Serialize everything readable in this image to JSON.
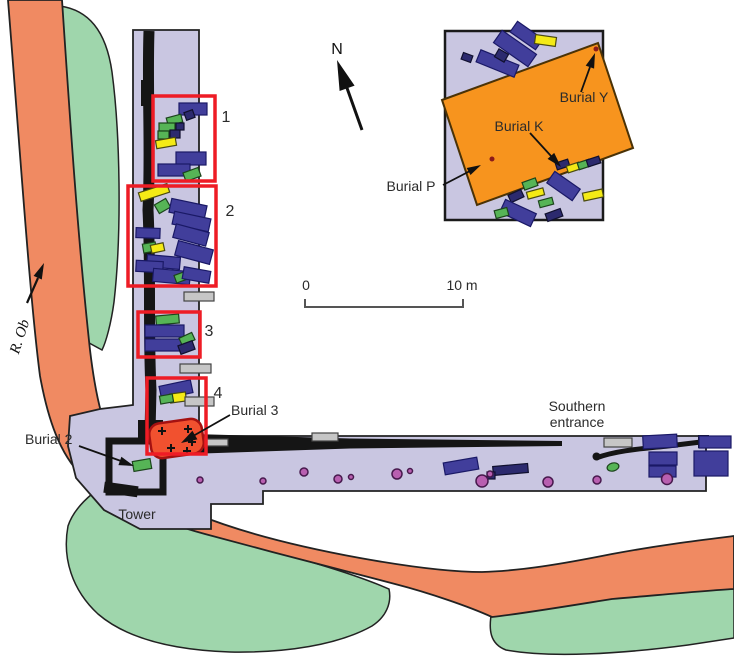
{
  "palette": {
    "background": "#ffffff",
    "site_fill": "#c9c6e1",
    "river_fill": "#f08a62",
    "vegetation_fill": "#9fd6ac",
    "outline": "#222222",
    "wall": "#151515",
    "excavation_red": "#ee1c25",
    "inset_structure_fill": "#f7941e",
    "inset_structure_stroke": "#4a3206",
    "burial3_fill": "#f1512f",
    "burial3_stroke": "#a51111",
    "pit_fill": "#b85fb0",
    "pit_stroke": "#47194d",
    "burial_dot": "#8b1a1a",
    "text": "#2b2b2b",
    "grave_colors": {
      "blue": {
        "fill": "#413e9b",
        "stroke": "#1a1966"
      },
      "navy": {
        "fill": "#2c2a6e",
        "stroke": "#10102e"
      },
      "green": {
        "fill": "#56b456",
        "stroke": "#1c441c"
      },
      "yellow": {
        "fill": "#f4ea16",
        "stroke": "#4a4a10"
      },
      "gray": {
        "fill": "#c6c6c6",
        "stroke": "#444444"
      }
    }
  },
  "map": {
    "north": "N",
    "river": "R. Ob",
    "tower": "Tower",
    "burial2": "Burial 2",
    "burial3": "Burial 3",
    "southern": [
      "Southern",
      "entrance"
    ],
    "scale_zero": "0",
    "scale_ten": "10 m"
  },
  "inset": {
    "burial_y": "Burial Y",
    "burial_k": "Burial K",
    "burial_p": "Burial P"
  },
  "excavation_areas": [
    {
      "x": 153,
      "y": 96,
      "w": 62,
      "h": 85,
      "label": "1",
      "lx": 226,
      "ly": 122
    },
    {
      "x": 128,
      "y": 186,
      "w": 88,
      "h": 100,
      "label": "2",
      "lx": 230,
      "ly": 216
    },
    {
      "x": 138,
      "y": 312,
      "w": 62,
      "h": 45,
      "label": "3",
      "lx": 209,
      "ly": 336
    },
    {
      "x": 147,
      "y": 378,
      "w": 59,
      "h": 76,
      "label": "4",
      "lx": 218,
      "ly": 398
    }
  ],
  "features": {
    "graves": [
      [
        179,
        103,
        28,
        12,
        0,
        "blue"
      ],
      [
        167,
        116,
        15,
        8,
        -15,
        "green"
      ],
      [
        185,
        111,
        9,
        8,
        -20,
        "navy"
      ],
      [
        159,
        123,
        16,
        8,
        0,
        "green"
      ],
      [
        176,
        123,
        8,
        7,
        0,
        "navy"
      ],
      [
        158,
        131,
        11,
        8,
        0,
        "green"
      ],
      [
        170,
        130,
        10,
        8,
        0,
        "navy"
      ],
      [
        156,
        139,
        20,
        8,
        -10,
        "yellow"
      ],
      [
        176,
        152,
        30,
        13,
        0,
        "blue"
      ],
      [
        158,
        164,
        32,
        12,
        0,
        "blue"
      ],
      [
        184,
        170,
        16,
        9,
        -20,
        "green"
      ],
      [
        139,
        188,
        30,
        9,
        -18,
        "yellow"
      ],
      [
        156,
        201,
        13,
        10,
        -30,
        "green"
      ],
      [
        170,
        202,
        36,
        14,
        12,
        "blue"
      ],
      [
        173,
        215,
        37,
        13,
        12,
        "blue"
      ],
      [
        136,
        228,
        24,
        10,
        2,
        "blue"
      ],
      [
        174,
        228,
        34,
        14,
        15,
        "blue"
      ],
      [
        143,
        243,
        13,
        9,
        -10,
        "green"
      ],
      [
        151,
        244,
        13,
        8,
        -12,
        "yellow"
      ],
      [
        176,
        245,
        36,
        15,
        15,
        "blue"
      ],
      [
        147,
        256,
        33,
        12,
        5,
        "blue"
      ],
      [
        136,
        261,
        27,
        11,
        3,
        "blue"
      ],
      [
        153,
        270,
        37,
        13,
        5,
        "blue"
      ],
      [
        175,
        273,
        13,
        8,
        -20,
        "green"
      ],
      [
        183,
        269,
        27,
        12,
        10,
        "blue"
      ],
      [
        156,
        315,
        23,
        9,
        -5,
        "green"
      ],
      [
        145,
        325,
        39,
        12,
        0,
        "blue"
      ],
      [
        145,
        339,
        39,
        12,
        0,
        "blue"
      ],
      [
        180,
        335,
        14,
        8,
        -25,
        "green"
      ],
      [
        179,
        343,
        15,
        9,
        -20,
        "navy"
      ],
      [
        160,
        383,
        32,
        13,
        -12,
        "blue"
      ],
      [
        170,
        393,
        16,
        9,
        -8,
        "yellow"
      ],
      [
        160,
        395,
        13,
        8,
        -10,
        "green"
      ],
      [
        444,
        460,
        34,
        12,
        -10,
        "blue"
      ],
      [
        493,
        465,
        35,
        9,
        -5,
        "navy"
      ],
      [
        487,
        472,
        8,
        7,
        0,
        "navy"
      ],
      [
        643,
        435,
        34,
        13,
        -3,
        "blue"
      ],
      [
        649,
        452,
        28,
        13,
        0,
        "blue"
      ],
      [
        649,
        466,
        27,
        11,
        0,
        "blue"
      ],
      [
        699,
        436,
        32,
        12,
        0,
        "blue"
      ],
      [
        694,
        451,
        34,
        25,
        0,
        "blue"
      ],
      [
        133,
        460,
        18,
        10,
        -10,
        "green"
      ],
      [
        184,
        292,
        30,
        9,
        0,
        "gray"
      ],
      [
        180,
        364,
        31,
        9,
        0,
        "gray"
      ],
      [
        185,
        397,
        29,
        9,
        0,
        "gray"
      ],
      [
        604,
        438,
        28,
        9,
        0,
        "gray"
      ],
      [
        312,
        433,
        26,
        8,
        0,
        "gray"
      ],
      [
        198,
        439,
        30,
        7,
        0,
        "gray"
      ]
    ],
    "inset_graves": [
      [
        511,
        29,
        31,
        13,
        35,
        "blue"
      ],
      [
        494,
        41,
        42,
        15,
        35,
        "blue"
      ],
      [
        535,
        36,
        21,
        9,
        8,
        "yellow"
      ],
      [
        477,
        57,
        41,
        13,
        22,
        "blue"
      ],
      [
        462,
        54,
        10,
        7,
        20,
        "navy"
      ],
      [
        496,
        51,
        11,
        9,
        30,
        "navy"
      ],
      [
        556,
        161,
        13,
        7,
        -18,
        "navy"
      ],
      [
        567,
        164,
        13,
        7,
        -18,
        "yellow"
      ],
      [
        578,
        161,
        12,
        7,
        -18,
        "green"
      ],
      [
        587,
        158,
        13,
        7,
        -18,
        "navy"
      ],
      [
        523,
        180,
        14,
        8,
        -20,
        "green"
      ],
      [
        527,
        190,
        17,
        7,
        -15,
        "yellow"
      ],
      [
        548,
        179,
        31,
        14,
        35,
        "blue"
      ],
      [
        509,
        192,
        14,
        8,
        -25,
        "navy"
      ],
      [
        539,
        199,
        14,
        7,
        -15,
        "green"
      ],
      [
        583,
        191,
        20,
        8,
        -12,
        "yellow"
      ],
      [
        501,
        206,
        34,
        14,
        25,
        "blue"
      ],
      [
        546,
        211,
        16,
        8,
        -20,
        "navy"
      ],
      [
        495,
        209,
        13,
        8,
        -15,
        "green"
      ]
    ],
    "pits": [
      [
        200,
        480,
        3
      ],
      [
        263,
        481,
        3
      ],
      [
        304,
        472,
        4
      ],
      [
        338,
        479,
        4
      ],
      [
        351,
        477,
        2.5
      ],
      [
        397,
        474,
        5
      ],
      [
        410,
        471,
        2.5
      ],
      [
        482,
        481,
        6
      ],
      [
        490,
        474,
        3
      ],
      [
        548,
        482,
        5
      ],
      [
        597,
        480,
        4
      ],
      [
        667,
        479,
        5.5
      ]
    ],
    "inset_dots": [
      [
        596,
        49,
        2.5
      ],
      [
        492,
        159,
        2.5
      ]
    ],
    "burial3_crosses": [
      [
        162,
        431
      ],
      [
        188,
        429
      ],
      [
        192,
        442
      ],
      [
        171,
        448
      ],
      [
        187,
        451
      ]
    ]
  }
}
